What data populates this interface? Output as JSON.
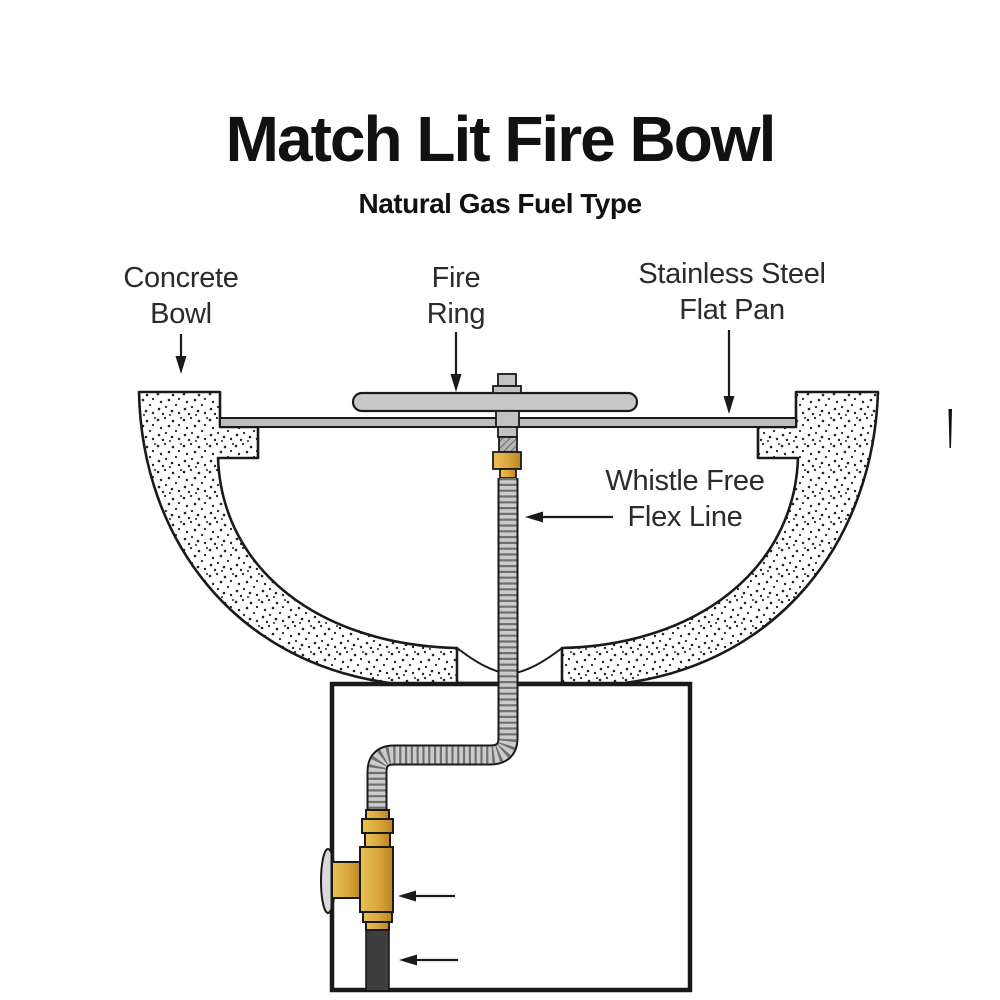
{
  "title": "Match Lit Fire Bowl",
  "subtitle": "Natural Gas Fuel Type",
  "labels": {
    "concrete_bowl": {
      "line1": "Concrete",
      "line2": "Bowl"
    },
    "fire_ring": {
      "line1": "Fire",
      "line2": "Ring"
    },
    "flat_pan": {
      "line1": "Stainless Steel",
      "line2": "Flat Pan"
    },
    "flex_line": {
      "line1": "Whistle Free",
      "line2": "Flex Line"
    },
    "key_valve": {
      "line1": "Chrome",
      "line2": "Key Valve"
    },
    "gas_line": {
      "line1": "Gas Line"
    }
  },
  "colors": {
    "brass": "#d8a63c",
    "metal_gray": "#c9c9c9",
    "pan_gray": "#bdbdbd",
    "fitting_gray": "#c2c2c2",
    "thread_gray": "#b5b5b5",
    "flex_gray": "#cccccc",
    "gas_dark": "#3e3e3e",
    "chrome": "#d9d9d9",
    "ink": "#1a1a1a"
  }
}
